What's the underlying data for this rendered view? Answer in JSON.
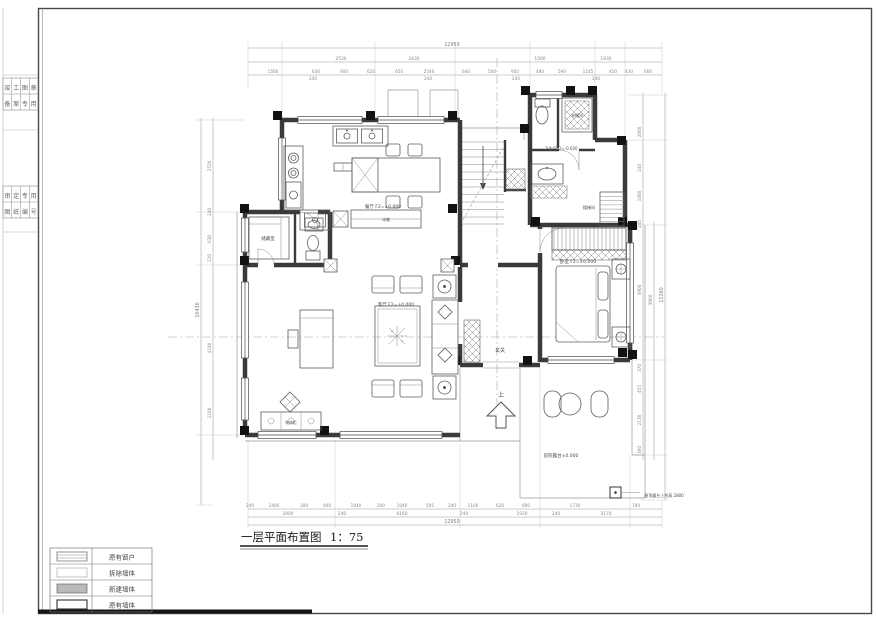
{
  "sheet": {
    "title": "一层平面布置图",
    "scale": "1：75"
  },
  "colors": {
    "ink": "#3a3a3a",
    "column": "#111111",
    "dim": "#8a8a8a",
    "new_wall_fill": "#b9b9b9"
  },
  "legend": {
    "items": [
      {
        "label": "原有窗户",
        "swatch": "window"
      },
      {
        "label": "拆除墙体",
        "swatch": "demolish"
      },
      {
        "label": "新建墙体",
        "swatch": "new-wall"
      },
      {
        "label": "原有墙体",
        "swatch": "existing-wall"
      }
    ]
  },
  "stamps": [
    {
      "x": 7.4,
      "y": 90,
      "t": "竣"
    },
    {
      "x": 16.1,
      "y": 90,
      "t": "工"
    },
    {
      "x": 24.9,
      "y": 90,
      "t": "图"
    },
    {
      "x": 33.6,
      "y": 90,
      "t": "章"
    },
    {
      "x": 7.4,
      "y": 106,
      "t": "备"
    },
    {
      "x": 16.1,
      "y": 106,
      "t": "案"
    },
    {
      "x": 24.9,
      "y": 106,
      "t": "专"
    },
    {
      "x": 33.6,
      "y": 106,
      "t": "用"
    },
    {
      "x": 7.4,
      "y": 198,
      "t": "审"
    },
    {
      "x": 16.1,
      "y": 198,
      "t": "定"
    },
    {
      "x": 24.9,
      "y": 198,
      "t": "专"
    },
    {
      "x": 33.6,
      "y": 198,
      "t": "用"
    },
    {
      "x": 7.4,
      "y": 214,
      "t": "图"
    },
    {
      "x": 16.1,
      "y": 214,
      "t": "纸"
    },
    {
      "x": 24.9,
      "y": 214,
      "t": "编"
    },
    {
      "x": 33.6,
      "y": 214,
      "t": "号"
    }
  ],
  "rooms": [
    {
      "x": 383,
      "y": 208,
      "t": "餐厅 F2=±0.000",
      "s": 4.5
    },
    {
      "x": 396,
      "y": 306,
      "t": "客厅 F2=±0.000",
      "s": 4.5
    },
    {
      "x": 578,
      "y": 263,
      "t": "卧室 F2=±0.000",
      "s": 4.5
    },
    {
      "x": 561,
      "y": 150,
      "t": "卫生间F2=-0.020",
      "s": 4
    },
    {
      "x": 577,
      "y": 117,
      "t": "衣帽间",
      "s": 4
    },
    {
      "x": 268,
      "y": 240,
      "t": "储藏室",
      "s": 4.5
    },
    {
      "x": 500,
      "y": 352,
      "t": "玄关",
      "s": 5
    },
    {
      "x": 589,
      "y": 209,
      "t": "楼梯间",
      "s": 4
    },
    {
      "x": 386,
      "y": 221,
      "t": "冰箱",
      "s": 3.8
    },
    {
      "x": 291,
      "y": 424,
      "t": "装饰柜",
      "s": 3.8
    },
    {
      "x": 561,
      "y": 457,
      "t": "前院露台±0.000",
      "s": 4.5
    },
    {
      "x": 664,
      "y": 497,
      "t": "屋顶露台上柱高 2800",
      "s": 4
    },
    {
      "x": 501,
      "y": 397,
      "t": "上",
      "s": 6
    }
  ],
  "dims": {
    "top_total": [
      {
        "x": 452,
        "y": 46,
        "t": "12950"
      }
    ],
    "top_mid": [
      {
        "x": 341,
        "y": 60,
        "t": "2530"
      },
      {
        "x": 414,
        "y": 60,
        "t": "2630"
      },
      {
        "x": 540,
        "y": 60,
        "t": "1500"
      },
      {
        "x": 606,
        "y": 60,
        "t": "1930"
      }
    ],
    "top_chain": [
      {
        "x": 273,
        "y": 73,
        "t": "1560"
      },
      {
        "x": 316,
        "y": 73,
        "t": "630"
      },
      {
        "x": 344,
        "y": 73,
        "t": "900"
      },
      {
        "x": 371,
        "y": 73,
        "t": "620"
      },
      {
        "x": 399,
        "y": 73,
        "t": "650"
      },
      {
        "x": 429,
        "y": 73,
        "t": "2540"
      },
      {
        "x": 466,
        "y": 73,
        "t": "640"
      },
      {
        "x": 492,
        "y": 73,
        "t": "500"
      },
      {
        "x": 515,
        "y": 73,
        "t": "950"
      },
      {
        "x": 540,
        "y": 73,
        "t": "480"
      },
      {
        "x": 562,
        "y": 73,
        "t": "590"
      },
      {
        "x": 588,
        "y": 73,
        "t": "1145"
      },
      {
        "x": 613,
        "y": 73,
        "t": "450"
      },
      {
        "x": 629,
        "y": 73,
        "t": "430"
      },
      {
        "x": 648,
        "y": 73,
        "t": "660"
      }
    ],
    "top_small": [
      {
        "x": 313,
        "y": 80,
        "t": "240",
        "s": 3.4
      },
      {
        "x": 428,
        "y": 80,
        "t": "240",
        "s": 3.4
      },
      {
        "x": 516,
        "y": 80,
        "t": "240",
        "s": 3.4
      },
      {
        "x": 596,
        "y": 80,
        "t": "240",
        "s": 3.4
      }
    ],
    "bottom_chain": [
      {
        "x": 250,
        "y": 507,
        "t": "240"
      },
      {
        "x": 274,
        "y": 507,
        "t": "2400"
      },
      {
        "x": 304,
        "y": 507,
        "t": "300"
      },
      {
        "x": 327,
        "y": 507,
        "t": "940"
      },
      {
        "x": 356,
        "y": 507,
        "t": "1040"
      },
      {
        "x": 381,
        "y": 507,
        "t": "240"
      },
      {
        "x": 402,
        "y": 507,
        "t": "1040"
      },
      {
        "x": 430,
        "y": 507,
        "t": "505"
      },
      {
        "x": 452,
        "y": 507,
        "t": "240"
      },
      {
        "x": 473,
        "y": 507,
        "t": "1100"
      },
      {
        "x": 500,
        "y": 507,
        "t": "620"
      },
      {
        "x": 526,
        "y": 507,
        "t": "690"
      },
      {
        "x": 575,
        "y": 507,
        "t": "1730"
      },
      {
        "x": 636,
        "y": 507,
        "t": "700"
      }
    ],
    "bottom_mid": [
      {
        "x": 288,
        "y": 515,
        "t": "3000"
      },
      {
        "x": 342,
        "y": 515,
        "t": "240"
      },
      {
        "x": 402,
        "y": 515,
        "t": "4160"
      },
      {
        "x": 464,
        "y": 515,
        "t": "240"
      },
      {
        "x": 522,
        "y": 515,
        "t": "1930"
      },
      {
        "x": 556,
        "y": 515,
        "t": "240"
      },
      {
        "x": 606,
        "y": 515,
        "t": "3170"
      }
    ],
    "bottom_total": [
      {
        "x": 452,
        "y": 523,
        "t": "12950"
      }
    ],
    "left_chain": [
      {
        "x": 211,
        "y": 166,
        "t": "2520",
        "r": -90
      },
      {
        "x": 211,
        "y": 212,
        "t": "240",
        "r": -90
      },
      {
        "x": 211,
        "y": 239,
        "t": "630",
        "r": -90
      },
      {
        "x": 211,
        "y": 258,
        "t": "120",
        "r": -90
      },
      {
        "x": 211,
        "y": 348,
        "t": "4190",
        "r": -90
      },
      {
        "x": 211,
        "y": 413,
        "t": "1100",
        "r": -90
      }
    ],
    "left_total": [
      {
        "x": 199,
        "y": 310,
        "t": "10430",
        "r": -90
      }
    ],
    "right_chain": [
      {
        "x": 641,
        "y": 132,
        "t": "2060",
        "r": -90
      },
      {
        "x": 641,
        "y": 168,
        "t": "240",
        "r": -90
      },
      {
        "x": 641,
        "y": 196,
        "t": "1060",
        "r": -90
      },
      {
        "x": 641,
        "y": 224,
        "t": "240",
        "r": -90
      },
      {
        "x": 641,
        "y": 290,
        "t": "3900",
        "r": -90
      },
      {
        "x": 641,
        "y": 368,
        "t": "370",
        "r": -90
      },
      {
        "x": 641,
        "y": 389,
        "t": "455",
        "r": -90
      },
      {
        "x": 641,
        "y": 420,
        "t": "2130",
        "r": -90
      },
      {
        "x": 641,
        "y": 450,
        "t": "360",
        "r": -90
      }
    ],
    "right_mid": [
      {
        "x": 652,
        "y": 300,
        "t": "3900",
        "r": -90
      }
    ],
    "right_total": [
      {
        "x": 663,
        "y": 295,
        "t": "11260",
        "r": -90
      }
    ]
  }
}
